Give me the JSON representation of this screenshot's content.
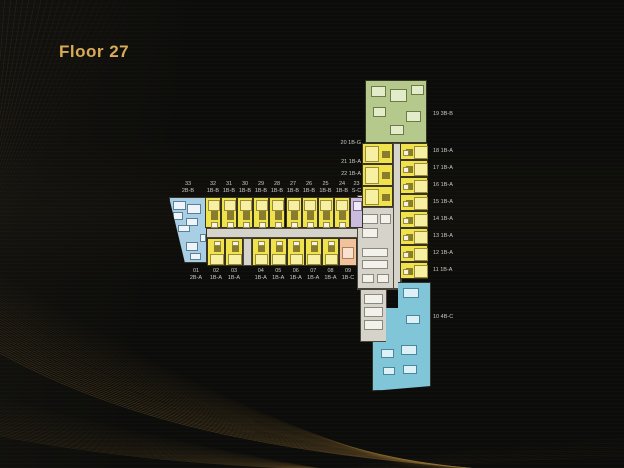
{
  "title": "Floor 27",
  "colors": {
    "background": "#0c0c0a",
    "gold_text": "#d7ab57",
    "gold_lines": "#9a7535",
    "label_text": "#c9c9c5",
    "unit_yellow": "#efe24d",
    "unit_yellow_room": "#f7f0a2",
    "unit_blue": "#a9cfe4",
    "unit_green": "#b6c98c",
    "unit_purple": "#c9bcdc",
    "unit_orange": "#f1c29c",
    "unit_cyan": "#80c5d8",
    "core_grey": "#d6d3ca",
    "room_white": "#f2f1ec"
  },
  "floor_plan": {
    "top_row": [
      {
        "no": "33",
        "type": "2B-B",
        "color": "blue"
      },
      {
        "no": "32",
        "type": "1B-B",
        "color": "yellow"
      },
      {
        "no": "31",
        "type": "1B-B",
        "color": "yellow"
      },
      {
        "no": "30",
        "type": "1B-B",
        "color": "yellow"
      },
      {
        "no": "29",
        "type": "1B-B",
        "color": "yellow"
      },
      {
        "no": "28",
        "type": "1B-B",
        "color": "yellow"
      },
      {
        "no": "27",
        "type": "1B-B",
        "color": "yellow"
      },
      {
        "no": "26",
        "type": "1B-B",
        "color": "yellow"
      },
      {
        "no": "25",
        "type": "1B-B",
        "color": "yellow"
      },
      {
        "no": "24",
        "type": "1B-B",
        "color": "yellow"
      },
      {
        "no": "23",
        "type": "S-C",
        "color": "purple"
      }
    ],
    "bottom_row": [
      {
        "no": "01",
        "type": "2B-A",
        "color": "blue"
      },
      {
        "no": "02",
        "type": "1B-A",
        "color": "yellow"
      },
      {
        "no": "03",
        "type": "1B-A",
        "color": "yellow"
      },
      {
        "no": "04",
        "type": "1B-A",
        "color": "yellow"
      },
      {
        "no": "05",
        "type": "1B-A",
        "color": "yellow"
      },
      {
        "no": "06",
        "type": "1B-A",
        "color": "yellow"
      },
      {
        "no": "07",
        "type": "1B-A",
        "color": "yellow"
      },
      {
        "no": "08",
        "type": "1B-A",
        "color": "yellow"
      },
      {
        "no": "09",
        "type": "1B-C",
        "color": "orange"
      }
    ],
    "left_column": [
      {
        "no": "20",
        "type": "1B-G",
        "color": "yellow"
      },
      {
        "no": "21",
        "type": "1B-A",
        "color": "yellow"
      },
      {
        "no": "22",
        "type": "1B-A",
        "color": "yellow"
      }
    ],
    "right_column": [
      {
        "no": "19",
        "type": "3B-B",
        "color": "green"
      },
      {
        "no": "18",
        "type": "1B-A",
        "color": "yellow"
      },
      {
        "no": "17",
        "type": "1B-A",
        "color": "yellow"
      },
      {
        "no": "16",
        "type": "1B-A",
        "color": "yellow"
      },
      {
        "no": "15",
        "type": "1B-A",
        "color": "yellow"
      },
      {
        "no": "14",
        "type": "1B-A",
        "color": "yellow"
      },
      {
        "no": "13",
        "type": "1B-A",
        "color": "yellow"
      },
      {
        "no": "12",
        "type": "1B-A",
        "color": "yellow"
      },
      {
        "no": "11",
        "type": "1B-A",
        "color": "yellow"
      },
      {
        "no": "10",
        "type": "4B-C",
        "color": "cyan"
      }
    ]
  }
}
